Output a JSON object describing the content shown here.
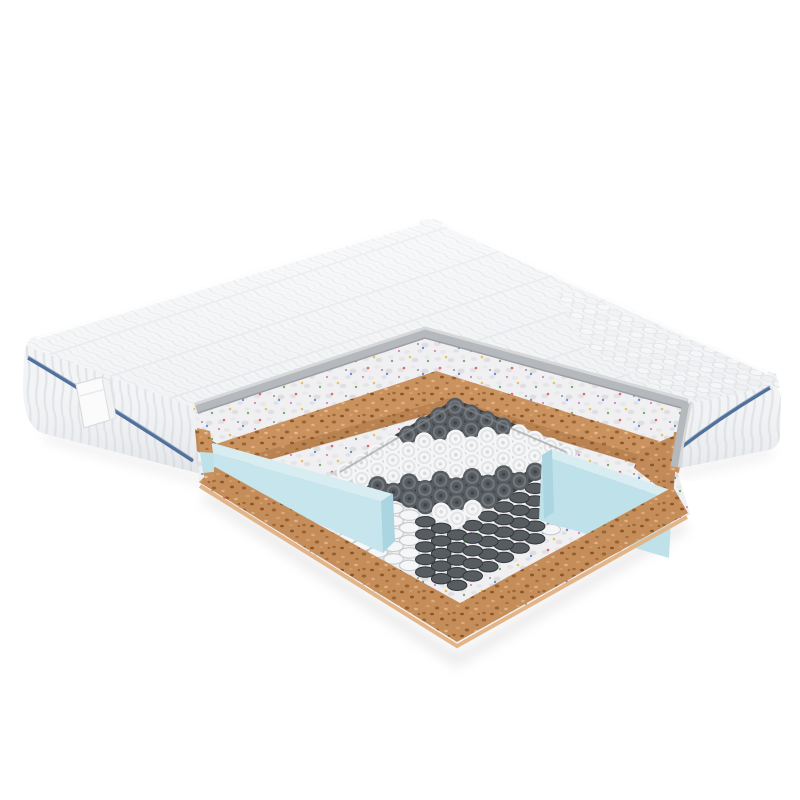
{
  "scene": {
    "subject": "mattress cross-section cutaway render",
    "background": "#ffffff"
  },
  "palette": {
    "quilt_base": "#f4f5f7",
    "quilt_line": "#dfe2e6",
    "stripe_base": "#f3f4f6",
    "stripe_line": "#e0e3e7",
    "piping": "#51719a",
    "piping_light": "#93abc6",
    "tag_fill": "#fbfbfc",
    "tag_edge": "#d9dcdf",
    "gray_band": "#b5b8bc",
    "gray_band_light": "#d6d8da",
    "gray_band_dark": "#9b9ea2",
    "fleck_base": "#f0f0f2",
    "cork_base": "#c9925f",
    "cork_cut_shade": "#8a5426",
    "cork_bottom_edge": "#e2b488",
    "foam_blue_top": "#d8edf2",
    "foam_blue_main": "#bfe2ea",
    "foam_blue_side": "#c6e5ec",
    "foam_blue_end": "#abd5e0",
    "crevice": "#8a8d90",
    "shadow": "#dedede",
    "top_shade_to": "#e3e6e9"
  },
  "springs": {
    "origin": [
      455,
      407
    ],
    "u": [
      -15.6,
      9.3
    ],
    "v": [
      15.9,
      6.6
    ],
    "count": 8,
    "disc_r": 9.2,
    "ring_r": 5.8,
    "center_r": 1.8,
    "stack_rx": 9.8,
    "stack_ry": 5.2,
    "stack_step": 12.6,
    "stack_count": 5,
    "bands": [
      {
        "max_k": 3,
        "color": "dark"
      },
      {
        "max_k": 8,
        "color": "white"
      },
      {
        "max_k": 12,
        "color": "dark"
      },
      {
        "max_k": 14,
        "color": "white"
      }
    ],
    "dark_stack_x": [
      416,
      548
    ],
    "white": {
      "fill": "#f5f6f7",
      "ring": "#e2e4e6",
      "center": "#d8dadc",
      "base": "#d2d3d5",
      "stack_stroke": "#c6c8cb"
    },
    "dark": {
      "fill": "#575c61",
      "ring": "#71777c",
      "center": "#404448",
      "base": "#3b3f43",
      "stack_stroke": "#33373b"
    }
  }
}
